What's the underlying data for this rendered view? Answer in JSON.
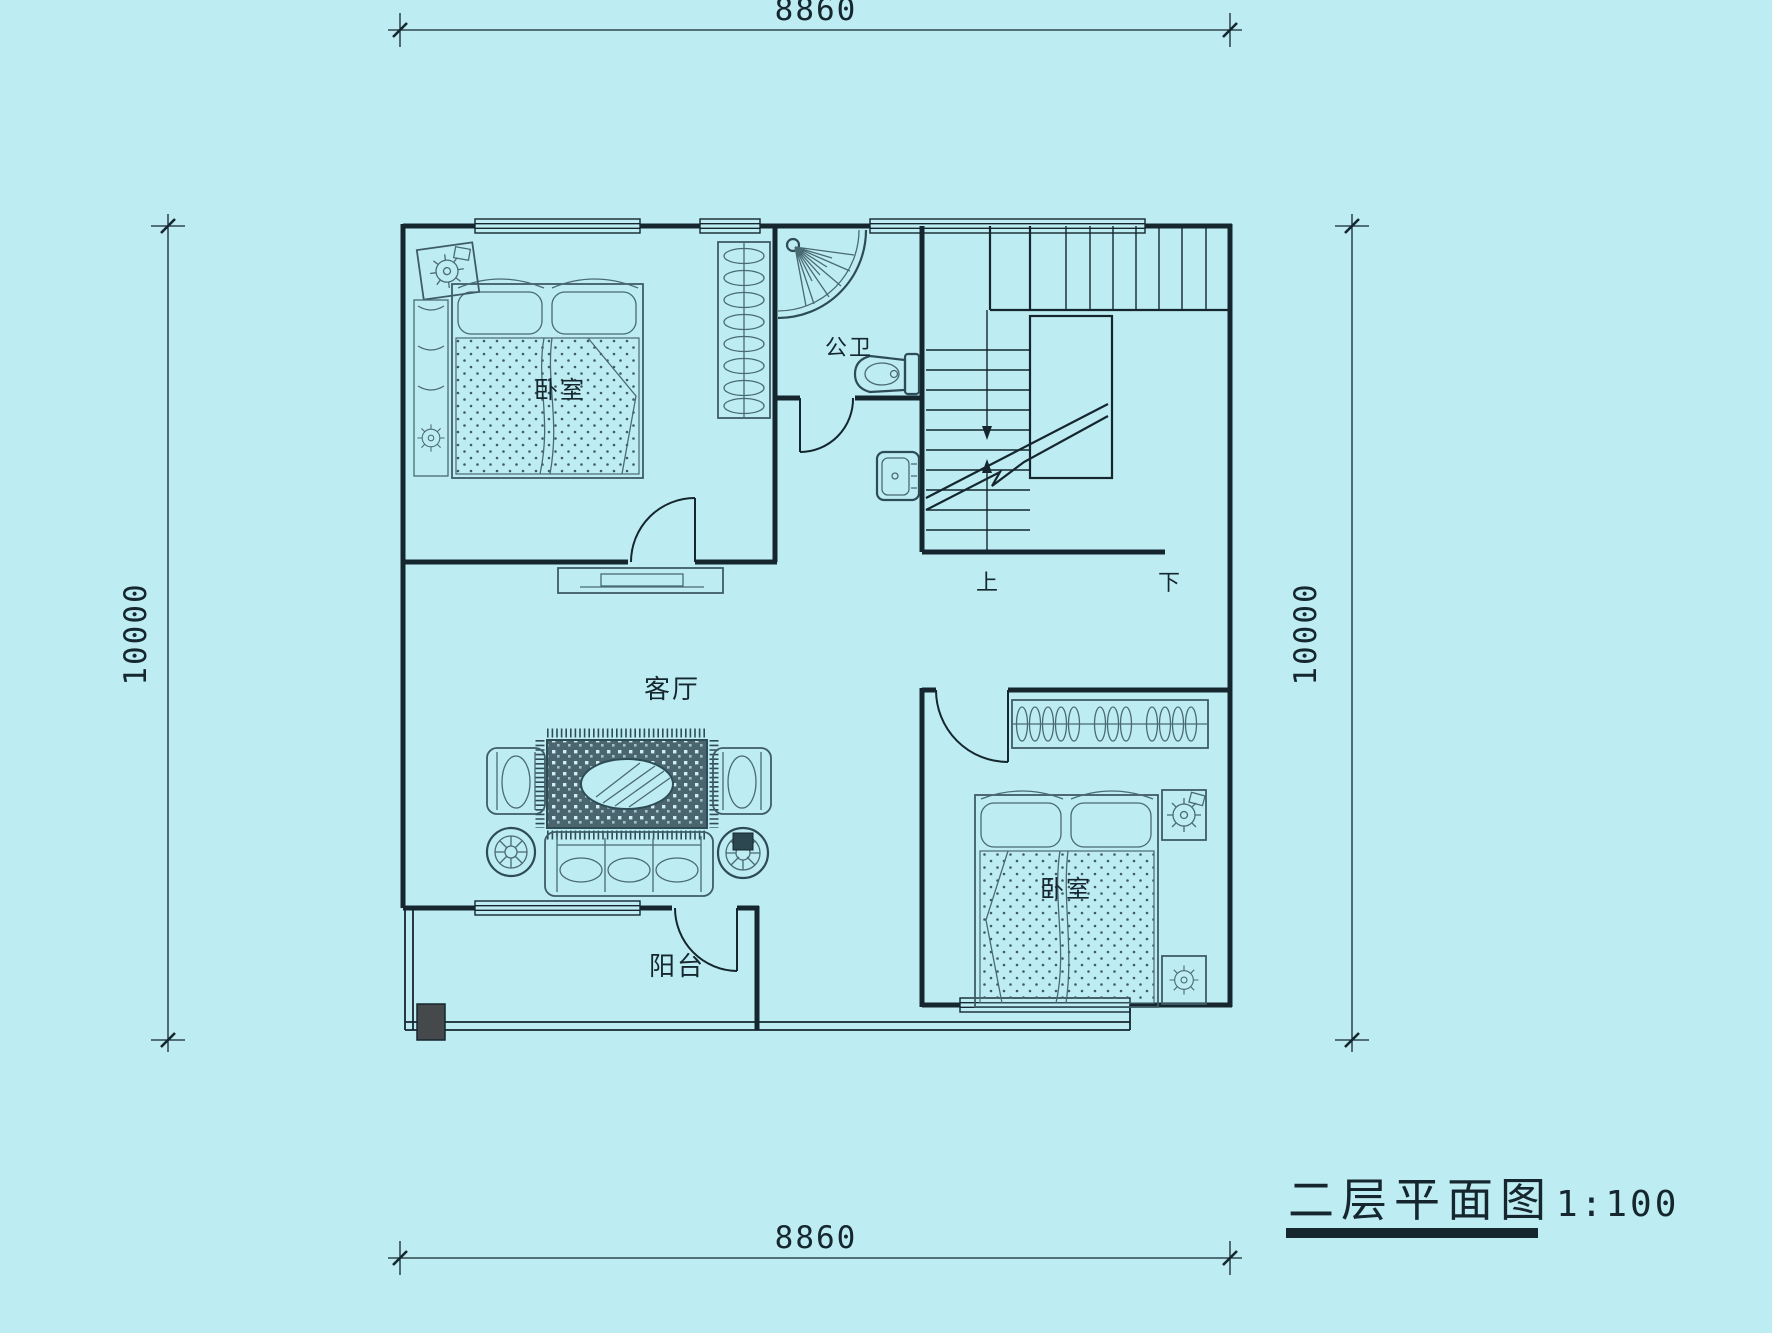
{
  "title": {
    "name": "二层平面图",
    "scale": "1:100"
  },
  "dimensions": {
    "top": "8860",
    "bottom": "8860",
    "left": "10000",
    "right": "10000"
  },
  "rooms": {
    "bedroom_top": "卧室",
    "bathroom": "公卫",
    "living": "客厅",
    "balcony": "阳台",
    "bedroom_bottom": "卧室"
  },
  "stairs": {
    "up": "上",
    "down": "下"
  },
  "colors": {
    "background": "#bdedf2",
    "ink": "#15262e",
    "furniture_line": "#3f5c66",
    "column_fill": "#45494c"
  }
}
